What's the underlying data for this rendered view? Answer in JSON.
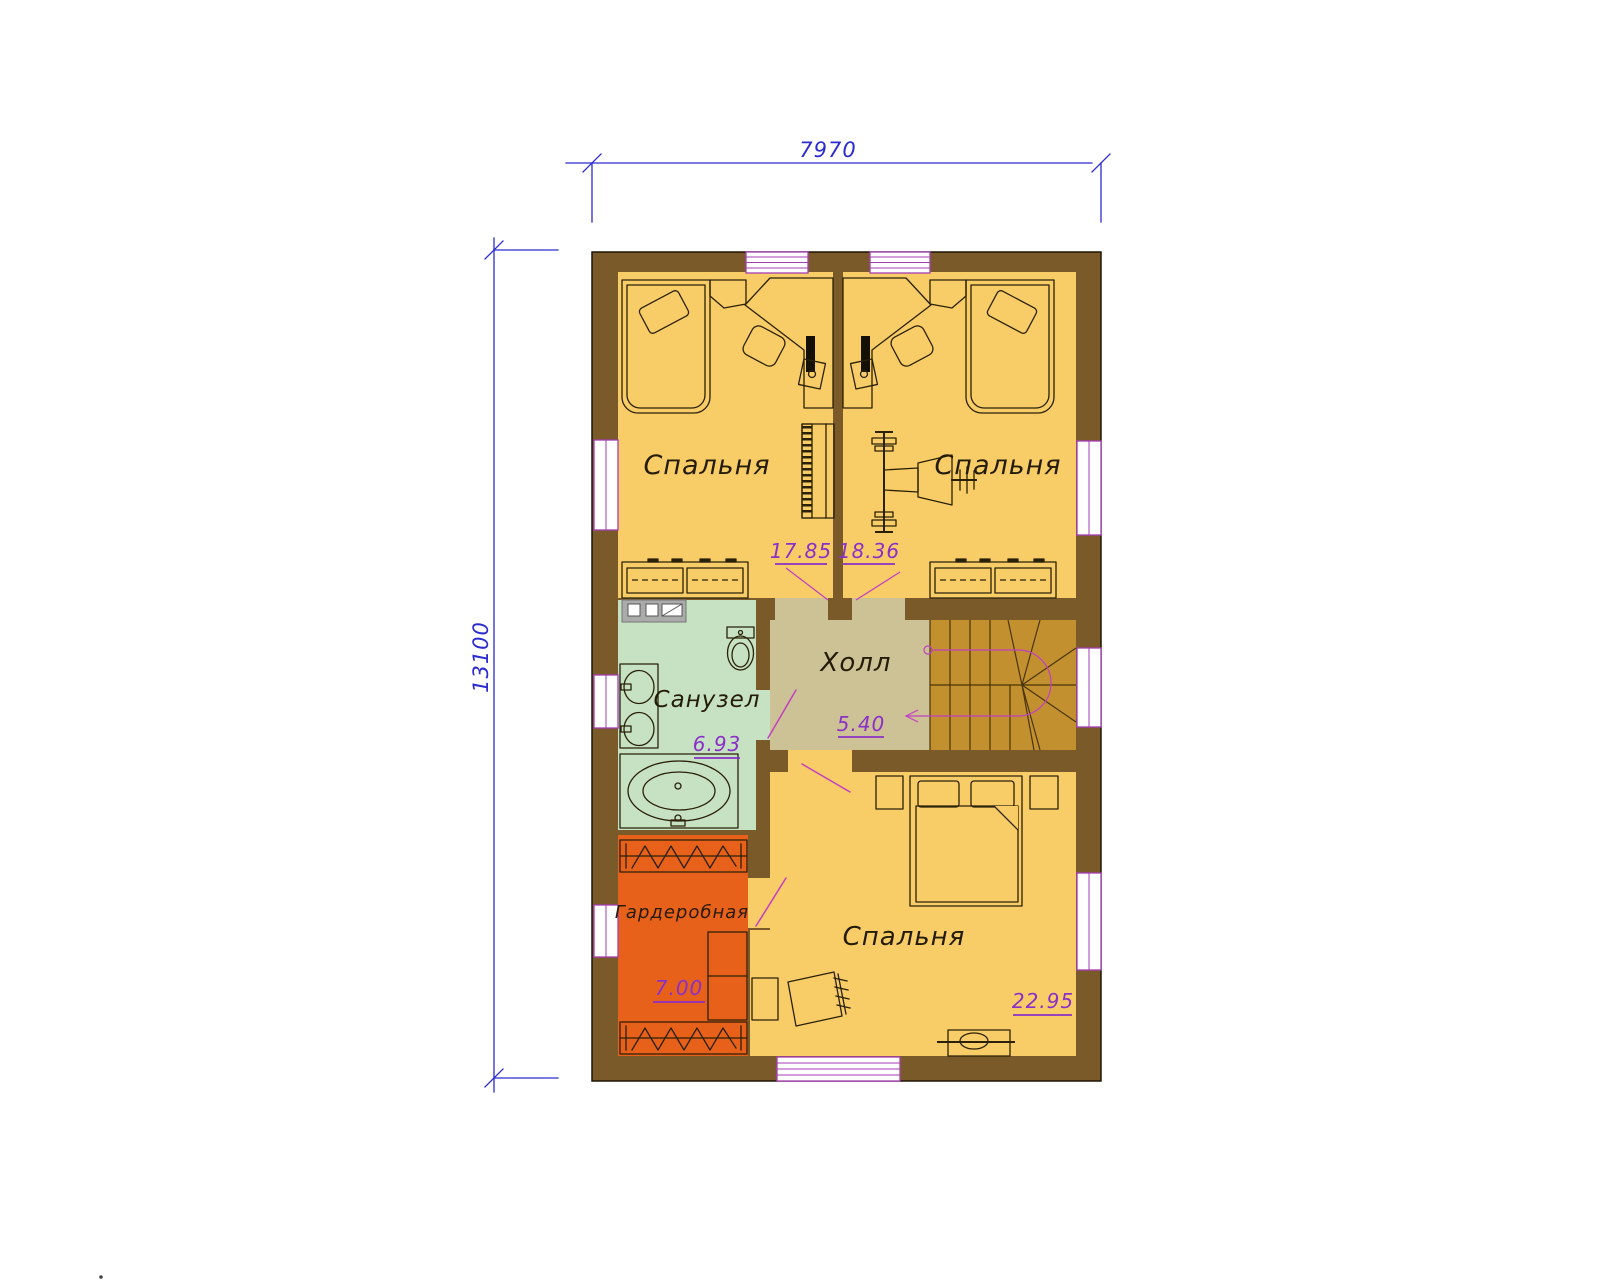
{
  "plan": {
    "dimensions": {
      "width": "7970",
      "height": "13100"
    },
    "rooms": [
      {
        "label": "Спальня",
        "area": "17.85"
      },
      {
        "label": "Спальня",
        "area": "18.36"
      },
      {
        "label": "Холл",
        "area": "5.40"
      },
      {
        "label": "Санузел",
        "area": "6.93"
      },
      {
        "label": "Гардеробная",
        "area": "7.00"
      },
      {
        "label": "Спальня",
        "area": "22.95"
      }
    ],
    "colors": {
      "wall": "#7a5a29",
      "room_floor": "#f8cd67",
      "hall_floor": "#ccc295",
      "stairs_floor": "#c3902f",
      "bathroom_floor": "#c7e2c3",
      "wardrobe_floor": "#e8611b",
      "vanity_gray": "#ababab",
      "window_frame": "#a43db4",
      "door_magenta": "#c23fc2",
      "dimension_blue": "#2b2bd0",
      "area_purple": "#8b2fc9",
      "outline": "#2a2108"
    }
  }
}
